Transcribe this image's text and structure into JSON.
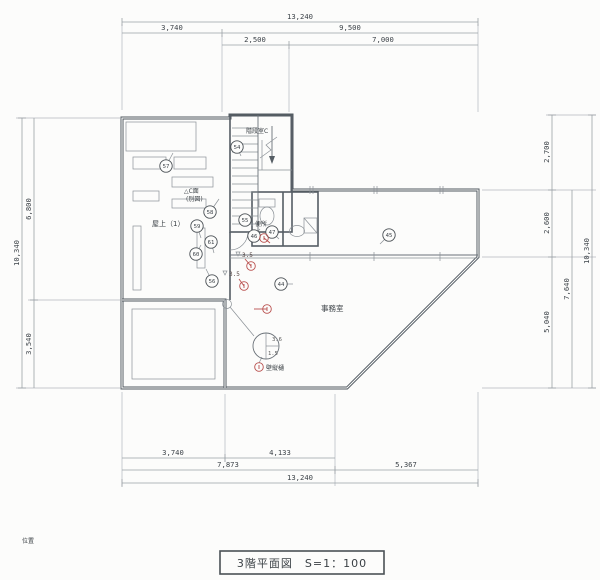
{
  "colors": {
    "paper": "#fcfcfb",
    "wall": "#4f575f",
    "dim_text": "#3c4248",
    "red_accent": "#b9504e"
  },
  "title_block": {
    "label": "3階平面図　S=1：100"
  },
  "corner_note": "位置",
  "rooms": {
    "stair": "階段室C",
    "toilet": "便所",
    "rooftop": "屋上（1）",
    "office": "事務室"
  },
  "annotations": {
    "c_plane_line1": "△C面",
    "c_plane_line2": "(別図)",
    "wall_gutter": "壁縦樋",
    "level_upper": "3.5",
    "level_lower": "3.5",
    "vent_upper": "3.6",
    "vent_lower": "1.5"
  },
  "dims": {
    "top": {
      "total": "13,240",
      "a": "3,740",
      "b": "9,500",
      "c": "2,500",
      "d": "7,000"
    },
    "left": {
      "total": "10,340",
      "a": "6,800",
      "b": "3,540"
    },
    "right": {
      "a": "2,700",
      "b": "2,600",
      "c": "5,040",
      "span": "7,640",
      "total": "10,340"
    },
    "bottom": {
      "a": "3,740",
      "b": "4,133",
      "c": "7,873",
      "d": "5,367",
      "total": "13,240"
    }
  },
  "ref_marks": [
    {
      "id": "44",
      "x": 281,
      "y": 284,
      "lx": 293,
      "ly": 284
    },
    {
      "id": "45",
      "x": 389,
      "y": 235,
      "lx": 380,
      "ly": 244
    },
    {
      "id": "46",
      "x": 254,
      "y": 236,
      "lx": 260,
      "ly": 229
    },
    {
      "id": "47",
      "x": 272,
      "y": 232,
      "lx": 279,
      "ly": 239
    },
    {
      "id": "54",
      "x": 237,
      "y": 147,
      "lx": 241,
      "ly": 156
    },
    {
      "id": "55",
      "x": 245,
      "y": 220,
      "lx": 253,
      "ly": 226
    },
    {
      "id": "56",
      "x": 212,
      "y": 281,
      "lx": 206,
      "ly": 269
    },
    {
      "id": "57",
      "x": 166,
      "y": 166,
      "lx": 173,
      "ly": 153
    },
    {
      "id": "58",
      "x": 210,
      "y": 212,
      "lx": 219,
      "ly": 199
    },
    {
      "id": "59",
      "x": 197,
      "y": 226,
      "lx": 201,
      "ly": 238
    },
    {
      "id": "60",
      "x": 196,
      "y": 254,
      "lx": 201,
      "ly": 245
    },
    {
      "id": "61",
      "x": 211,
      "y": 242,
      "lx": 214,
      "ly": 253
    }
  ],
  "red_marks": [
    {
      "x": 251,
      "y": 266,
      "lx": 245,
      "ly": 259
    },
    {
      "x": 244,
      "y": 286,
      "lx": 239,
      "ly": 279
    },
    {
      "x": 267,
      "y": 309,
      "lx": 254,
      "ly": 309
    },
    {
      "x": 264,
      "y": 238,
      "lx": 270,
      "ly": 243
    },
    {
      "x": 259,
      "y": 367
    }
  ]
}
